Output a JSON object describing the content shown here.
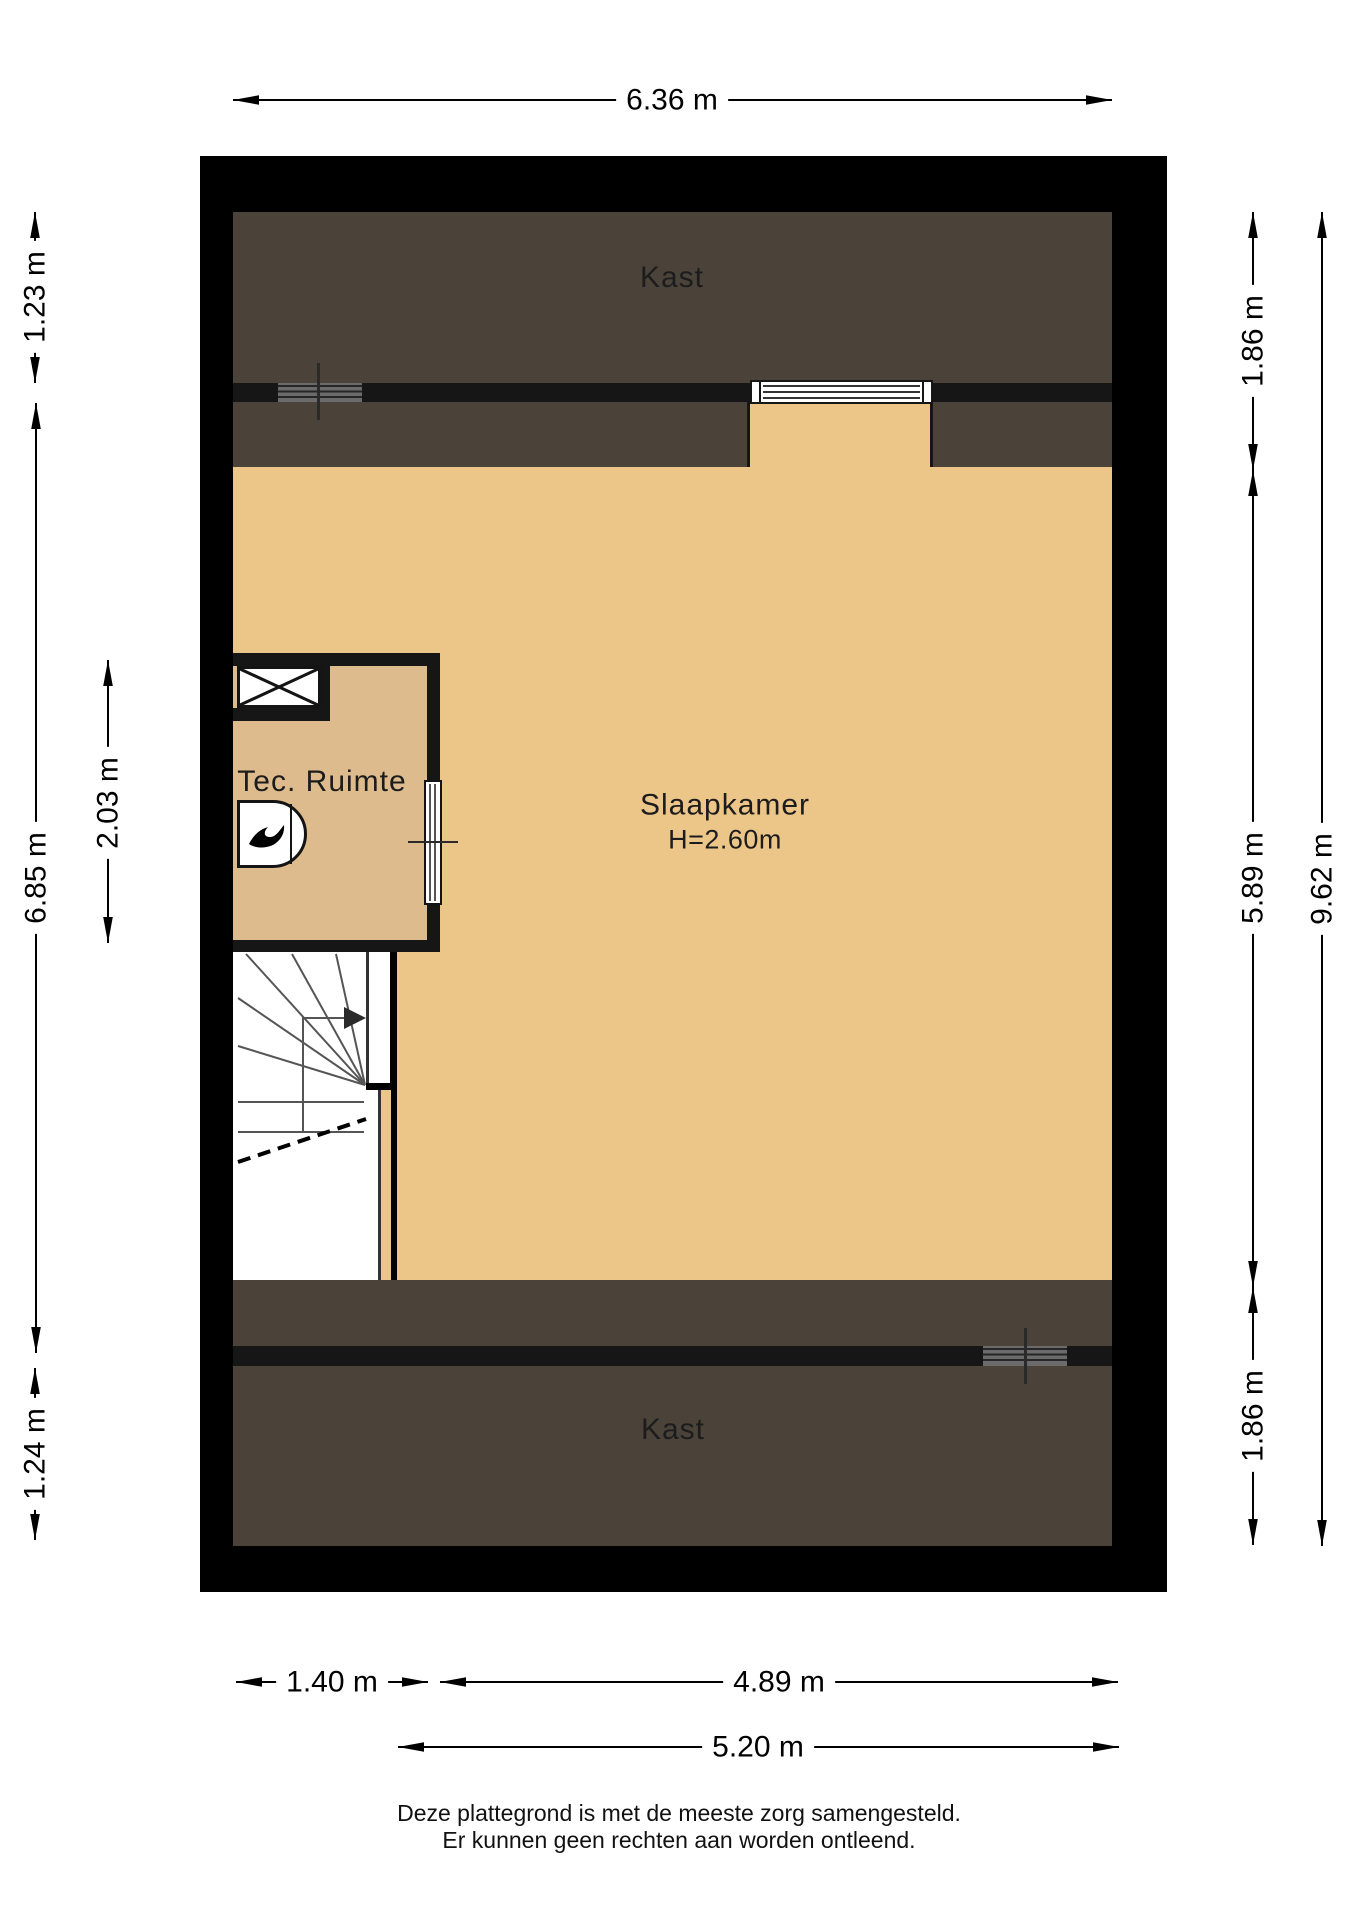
{
  "plan": {
    "rooms": {
      "kast_top": "Kast",
      "slaapkamer": "Slaapkamer",
      "slaapkamer_height": "H=2.60m",
      "tec_ruimte": "Tec. Ruimte",
      "kast_bottom": "Kast"
    },
    "dimensions": {
      "top_width": "6.36 m",
      "left_top": "1.23 m",
      "left_middle": "6.85 m",
      "tec_height": "2.03 m",
      "left_bottom": "1.24 m",
      "right_top": "1.86 m",
      "right_middle": "5.89 m",
      "right_bottom": "1.86 m",
      "right_total": "9.62 m",
      "bottom_left": "1.40 m",
      "bottom_right": "4.89 m",
      "bottom_total": "5.20 m"
    },
    "colors": {
      "wall": "#000000",
      "closet_fill": "#4b433a",
      "bedroom_floor": "#ecc588",
      "tec_floor": "#debb8d"
    },
    "icons": {
      "boiler": "flame-icon",
      "stairs": "stairs-up-arrow-icon"
    }
  },
  "footer": {
    "line1": "Deze plattegrond is met de meeste zorg samengesteld.",
    "line2": "Er kunnen geen rechten aan worden ontleend."
  }
}
